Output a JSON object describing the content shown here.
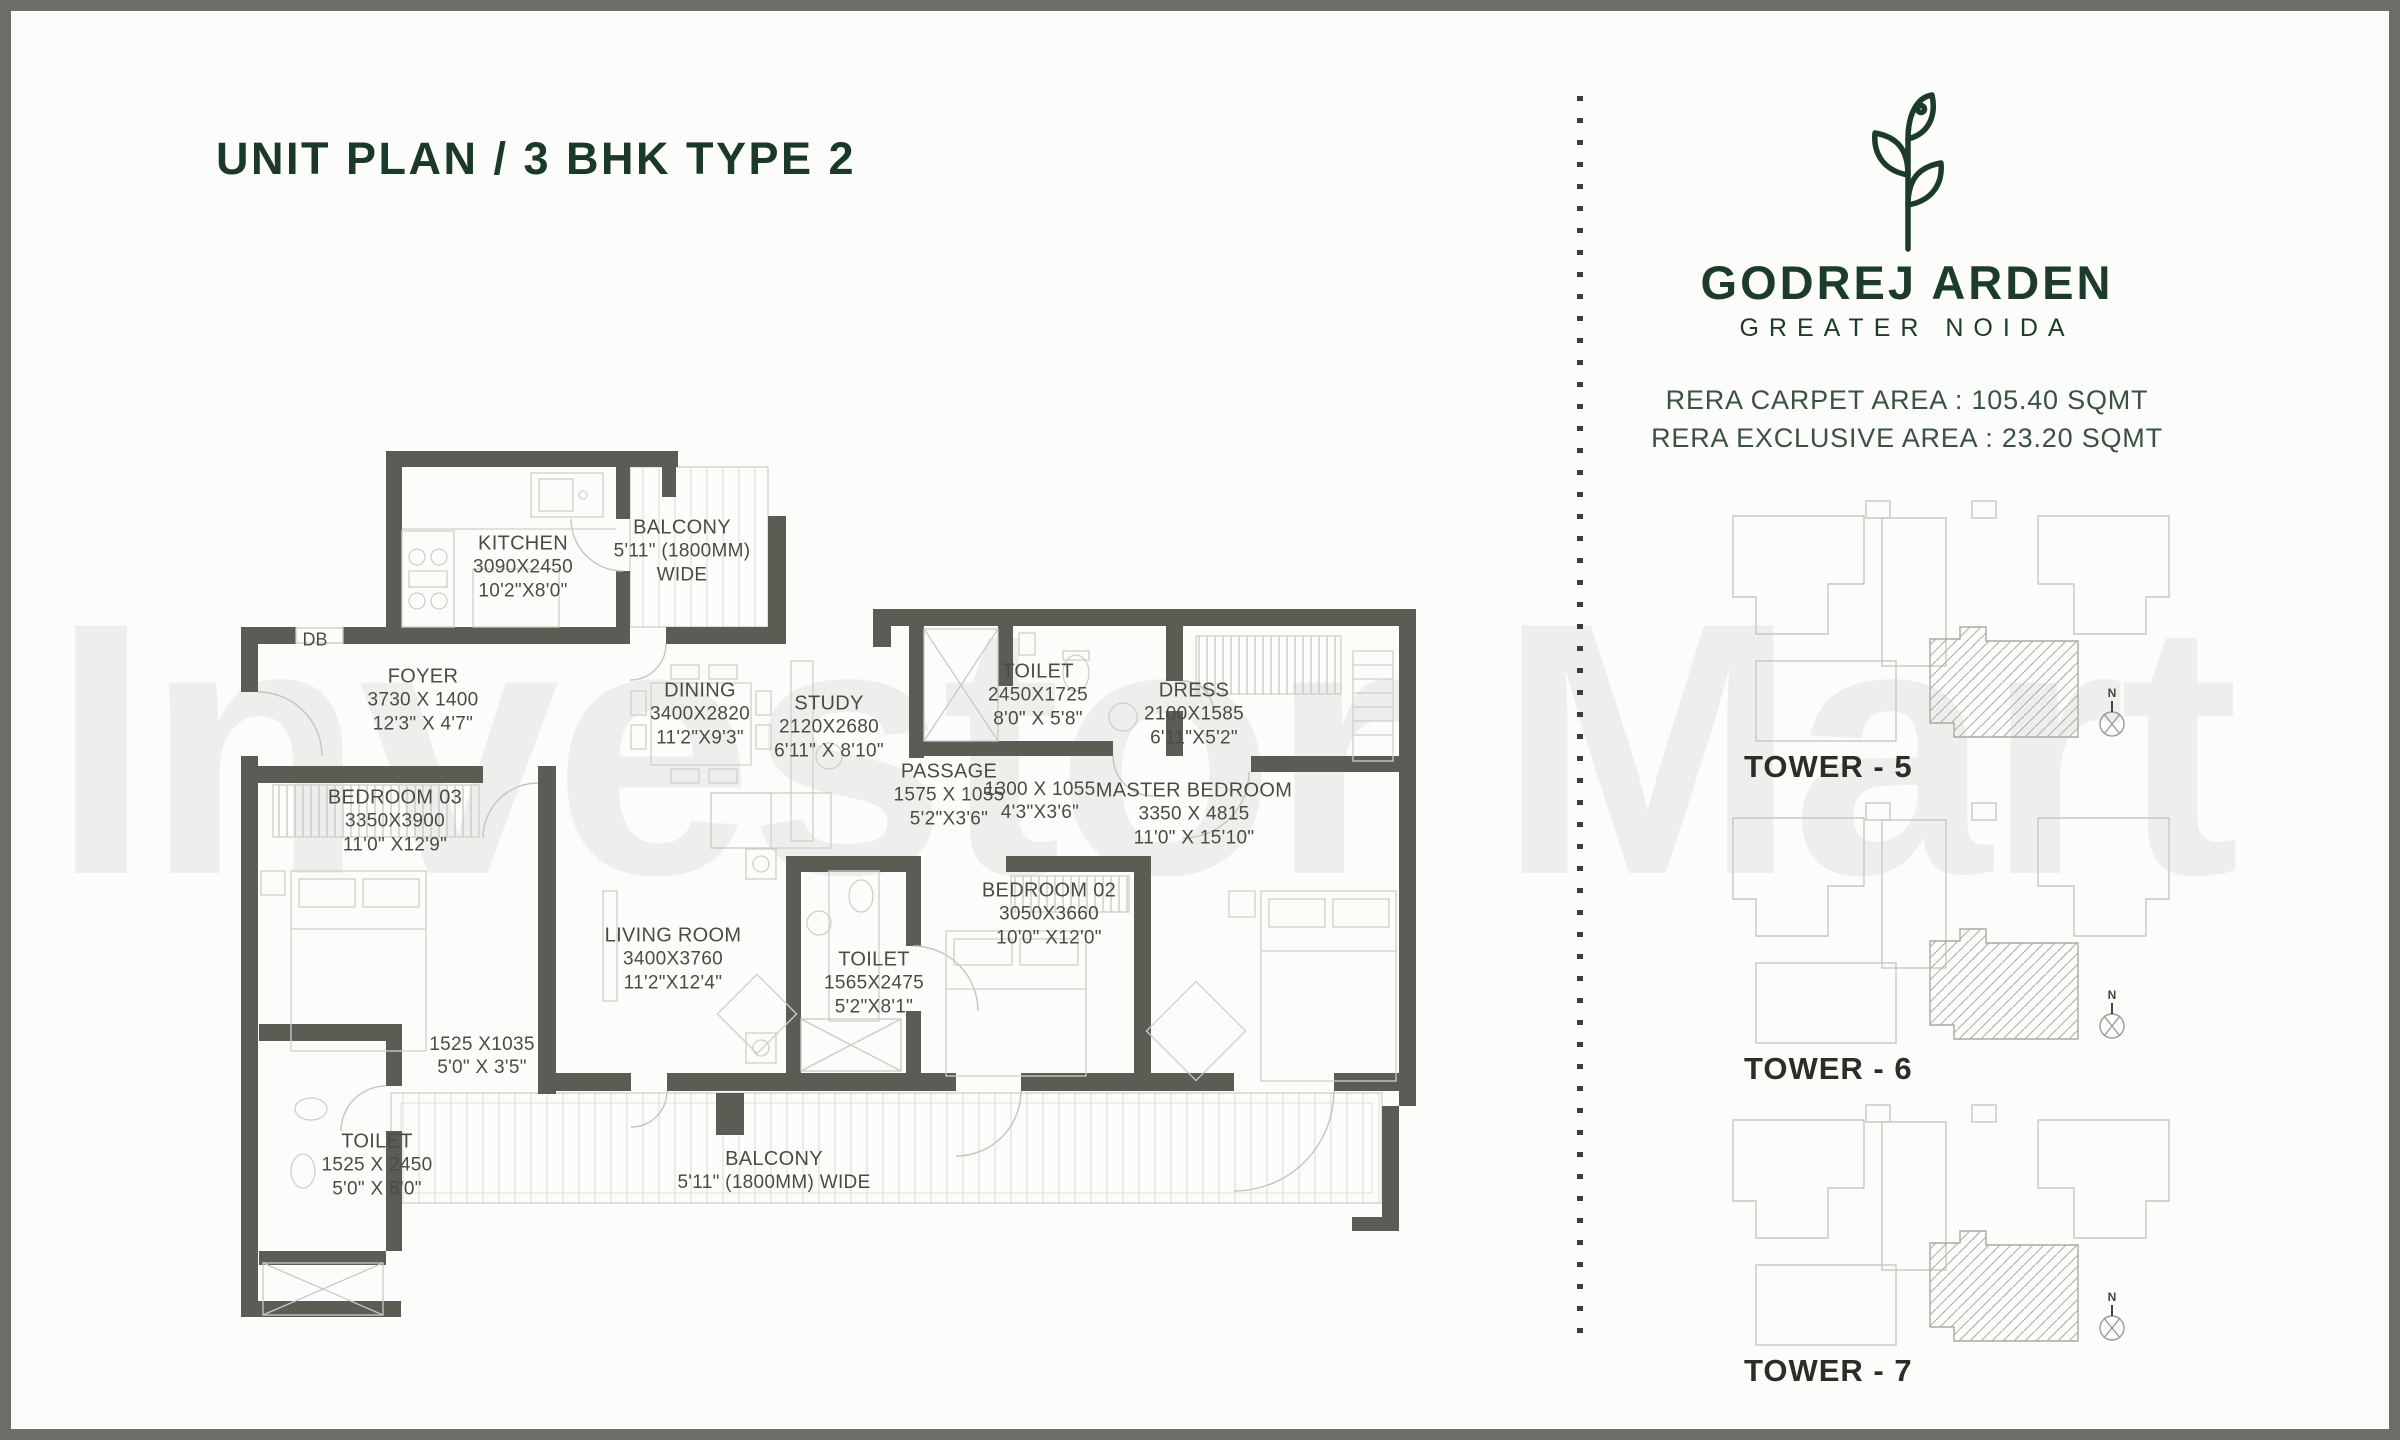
{
  "page": {
    "title": "UNIT PLAN / 3 BHK TYPE 2",
    "watermark": "Investor Mart"
  },
  "brand": {
    "name": "GODREJ ARDEN",
    "location": "GREATER NOIDA",
    "rera_carpet": "RERA CARPET AREA : 105.40 SQMT",
    "rera_exclusive": "RERA EXCLUSIVE AREA : 23.20 SQMT"
  },
  "compass": {
    "label": "N"
  },
  "towers": [
    {
      "label": "TOWER - 5"
    },
    {
      "label": "TOWER - 6"
    },
    {
      "label": "TOWER - 7"
    }
  ],
  "plan": {
    "db_label": "DB",
    "rooms": [
      {
        "id": "kitchen",
        "name": "KITCHEN",
        "dim_mm": "3090X2450",
        "dim_ft": "10'2\"X8'0\""
      },
      {
        "id": "balcony-top",
        "name": "BALCONY",
        "dim_mm": "5'11\" (1800MM)",
        "dim_ft": "WIDE"
      },
      {
        "id": "foyer",
        "name": "FOYER",
        "dim_mm": "3730 X 1400",
        "dim_ft": "12'3\" X 4'7\""
      },
      {
        "id": "dining",
        "name": "DINING",
        "dim_mm": "3400X2820",
        "dim_ft": "11'2\"X9'3\""
      },
      {
        "id": "study",
        "name": "STUDY",
        "dim_mm": "2120X2680",
        "dim_ft": "6'11\" X 8'10\""
      },
      {
        "id": "toilet-1",
        "name": "TOILET",
        "dim_mm": "2450X1725",
        "dim_ft": "8'0\" X 5'8\""
      },
      {
        "id": "dress",
        "name": "DRESS",
        "dim_mm": "2100X1585",
        "dim_ft": "6'11\"X5'2\""
      },
      {
        "id": "passage",
        "name": "PASSAGE",
        "dim_mm": "1575 X 1055",
        "dim_ft": "5'2\"X3'6\""
      },
      {
        "id": "lobby",
        "name": "",
        "dim_mm": "1300 X 1055",
        "dim_ft": "4'3\"X3'6\""
      },
      {
        "id": "master-bedroom",
        "name": "MASTER BEDROOM",
        "dim_mm": "3350 X 4815",
        "dim_ft": "11'0\" X 15'10\""
      },
      {
        "id": "bedroom-03",
        "name": "BEDROOM 03",
        "dim_mm": "3350X3900",
        "dim_ft": "11'0\" X12'9\""
      },
      {
        "id": "living-room",
        "name": "LIVING ROOM",
        "dim_mm": "3400X3760",
        "dim_ft": "11'2\"X12'4\""
      },
      {
        "id": "toilet-2",
        "name": "TOILET",
        "dim_mm": "1565X2475",
        "dim_ft": "5'2\"X8'1\""
      },
      {
        "id": "bedroom-02",
        "name": "BEDROOM 02",
        "dim_mm": "3050X3660",
        "dim_ft": "10'0\" X12'0\""
      },
      {
        "id": "toilet-lobby",
        "name": "",
        "dim_mm": "1525 X1035",
        "dim_ft": "5'0\" X 3'5\""
      },
      {
        "id": "toilet-3",
        "name": "TOILET",
        "dim_mm": "1525 X 2450",
        "dim_ft": "5'0\" X 8'0\""
      },
      {
        "id": "balcony-bottom",
        "name": "BALCONY",
        "dim_mm": "5'11\" (1800MM) WIDE",
        "dim_ft": ""
      }
    ]
  },
  "colors": {
    "accent_green": "#1d3b2a",
    "rera_text": "#3c5146",
    "wall_gray": "#5c5c55",
    "frame_gray": "#6e6e69"
  }
}
